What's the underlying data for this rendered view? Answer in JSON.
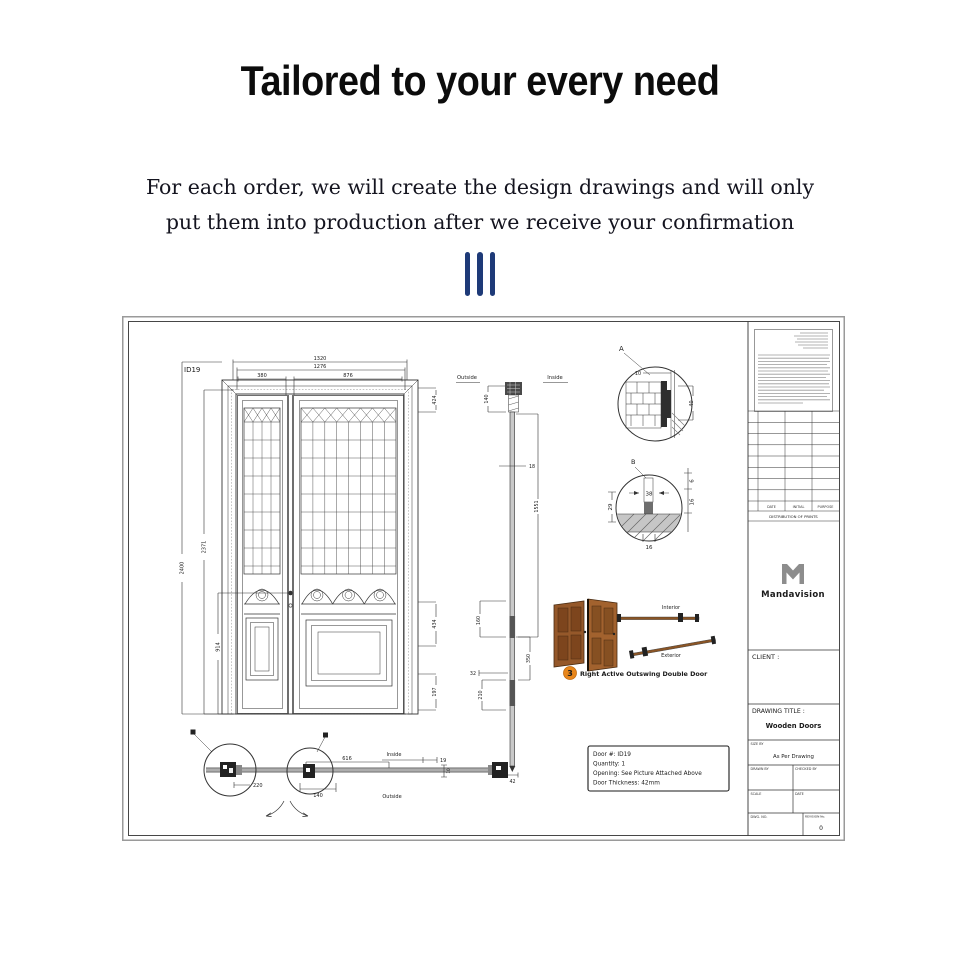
{
  "header": {
    "title": "Tailored to your every need",
    "subtitle_line1": "For each order, we will create the design drawings and will only",
    "subtitle_line2": "put them into production after we receive your confirmation",
    "divider_color": "#1e3a78"
  },
  "drawing": {
    "elevation": {
      "id_label": "ID19",
      "dim_overall_w": "1320",
      "dim_frame_w": "1276",
      "dim_left_leaf_w": "380",
      "dim_right_leaf_w": "876",
      "dim_overall_h": "2400",
      "dim_frame_h": "2371",
      "dim_handle_h": "914",
      "dim_top_424": "424",
      "dim_mid_434": "434",
      "dim_bottom_197": "197"
    },
    "section": {
      "label_outside": "Outside",
      "label_inside": "Inside",
      "dim_140": "140",
      "dim_18": "18",
      "dim_1551": "1551",
      "dim_160": "160",
      "dim_350": "350",
      "dim_32": "32",
      "dim_210": "210",
      "dim_42": "42"
    },
    "detail_a": {
      "label": "A",
      "dim_10": "10",
      "dim_40": "40"
    },
    "detail_b": {
      "label": "B",
      "dim_38": "38",
      "dim_29": "29",
      "dim_6": "6",
      "dim_16_side": "16",
      "dim_16_bottom": "16"
    },
    "swing": {
      "badge": "3",
      "badge_color": "#e8861b",
      "door_color": "#95582a",
      "label": "Right Active Outswing Double Door",
      "label_interior": "Interior",
      "label_exterior": "Exterior"
    },
    "plan": {
      "label_inside": "Inside",
      "label_outside": "Outside",
      "dim_220": "220",
      "dim_140": "140",
      "dim_616": "616",
      "dim_19": "19",
      "dim_10": "10"
    },
    "info_box": {
      "line1": "Door #: ID19",
      "line2": "Quantity: 1",
      "line3": "Opening: See Picture Attached Above",
      "line4": "Door Thickness:  42mm"
    },
    "title_block": {
      "rev_headers": [
        "DATE",
        "INITIAL",
        "PURPOSE"
      ],
      "distribution": "DISTRIBUTION OF PRINTS",
      "brand": "Mandavision",
      "client_label": "CLIENT :",
      "drawing_title_label": "DRAWING TITLE :",
      "drawing_title": "Wooden Doors",
      "size_label": "SIZE BY",
      "size_value": "As Per Drawing",
      "drawn_label": "DRAWN BY",
      "checked_label": "CHECKED BY",
      "scale_label": "SCALE",
      "date_label": "DATE",
      "dwg_label": "DWG. NO.",
      "rev_label": "REVISION No.",
      "rev_value": "0"
    }
  }
}
